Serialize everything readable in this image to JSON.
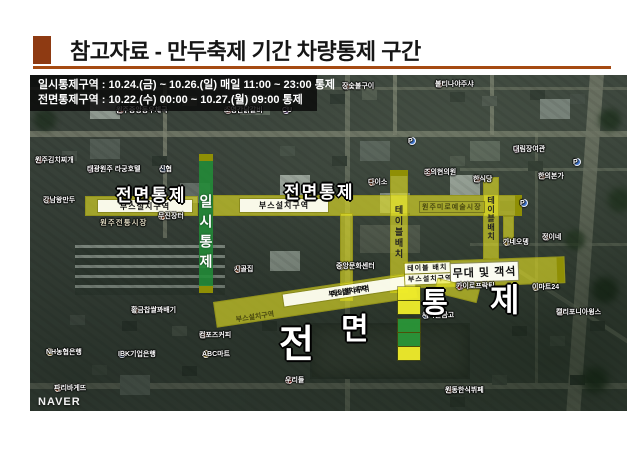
{
  "slide": {
    "title": "참고자료 - 만두축제 기간 차량통제 구간"
  },
  "info_box": {
    "line1": "일시통제구역 : 10.24.(금) ~ 10.26.(일) 매일 11:00 ~ 23:00 통제",
    "line2": "전면통제구역 : 10.22.(수) 00:00 ~ 10.27.(월) 09:00 통제"
  },
  "map": {
    "attribution": "NAVER",
    "labels": {
      "full_control_left": "전면통제",
      "full_control_mid": "전면통제",
      "temp_control": "일시통제",
      "big_letters": [
        "전",
        "면",
        "통",
        "제"
      ],
      "market": "원주미로예술시장"
    },
    "strips": {
      "booth_left": "부스설치구역",
      "booth_mid": "부스설치구역",
      "table_vertical": "테이블배치",
      "table_vertical2": "테이블배치",
      "table_bottom": "테이블 배치",
      "booth_bottom": "부스설치구역",
      "booth_bottom_small": "부스설치구역",
      "table_stage": "테이블 배치",
      "booth_stage": "부스설치구역",
      "stage": "무대 및 객석"
    },
    "permits": [
      {
        "text": "택배",
        "kind": "yellow"
      },
      {
        "text": "지점",
        "kind": "yellow"
      },
      {
        "text": "조업",
        "kind": "green"
      },
      {
        "text": "차량",
        "kind": "green"
      },
      {
        "text": "허용",
        "kind": "yellow"
      }
    ],
    "pois": [
      {
        "text": "장숯불구이",
        "x": 312,
        "y": 11,
        "dot": "#e8814d"
      },
      {
        "text": "불티나야주샤",
        "x": 405,
        "y": 9,
        "dot": "#e8814d"
      },
      {
        "text": "원주중앙동우체국",
        "x": 86,
        "y": 35,
        "dot": "#d9453a"
      },
      {
        "text": "소영간닭갈비",
        "x": 194,
        "y": 35,
        "dot": "#d9453a"
      },
      {
        "text": "CU",
        "x": 252,
        "y": 35,
        "dot": "#8b5fb8"
      },
      {
        "text": "원주김치찌개",
        "x": 5,
        "y": 85,
        "dot": "#d9453a"
      },
      {
        "text": "태광원주 라궁호텔",
        "x": 57,
        "y": 94,
        "dot": "#e084c0"
      },
      {
        "text": "신협",
        "x": 129,
        "y": 94,
        "dot": "#4a7fd4"
      },
      {
        "text": "강남왕만두",
        "x": 13,
        "y": 125,
        "dot": "#e8814d"
      },
      {
        "text": "무진장터",
        "x": 128,
        "y": 141,
        "dot": "#e8814d"
      },
      {
        "text": "원주전통시장",
        "x": 70,
        "y": 147,
        "dot": ""
      },
      {
        "text": "다이소",
        "x": 338,
        "y": 107,
        "dot": "#e8814d"
      },
      {
        "text": "조의현의원",
        "x": 394,
        "y": 97,
        "dot": "#d9453a"
      },
      {
        "text": "한식당",
        "x": 443,
        "y": 104,
        "dot": "#e8814d"
      },
      {
        "text": "대림장여관",
        "x": 483,
        "y": 74,
        "dot": "#e084c0"
      },
      {
        "text": "한의본가",
        "x": 508,
        "y": 101,
        "dot": "#e8814d"
      },
      {
        "text": "정이네",
        "x": 512,
        "y": 162,
        "dot": "#e8814d"
      },
      {
        "text": "시골집",
        "x": 204,
        "y": 194,
        "dot": "#e8814d"
      },
      {
        "text": "중앙문화센터",
        "x": 306,
        "y": 191,
        "dot": "#e3b93c"
      },
      {
        "text": "가네오뎅",
        "x": 473,
        "y": 167,
        "dot": "#e3b93c"
      },
      {
        "text": "이마트24",
        "x": 502,
        "y": 212,
        "dot": "#e3b93c"
      },
      {
        "text": "캘리포니아윙스",
        "x": 526,
        "y": 237,
        "dot": "#e8814d"
      },
      {
        "text": "새마을금고",
        "x": 392,
        "y": 240,
        "dot": "#4a7fd4"
      },
      {
        "text": "컴포즈커피",
        "x": 169,
        "y": 260,
        "dot": "#e8814d"
      },
      {
        "text": "ABC마트",
        "x": 172,
        "y": 279,
        "dot": "#e3b93c"
      },
      {
        "text": "NH농협은행",
        "x": 16,
        "y": 277,
        "dot": "#f0c030"
      },
      {
        "text": "IBK기업은행",
        "x": 88,
        "y": 279,
        "dot": "#4a7fd4"
      },
      {
        "text": "황금찹쌀꽈배기",
        "x": 101,
        "y": 235,
        "dot": "#e8814d"
      },
      {
        "text": "파리바게뜨",
        "x": 24,
        "y": 313,
        "dot": "#e8814d"
      },
      {
        "text": "우리들",
        "x": 255,
        "y": 305,
        "dot": "#d9453a"
      },
      {
        "text": "원동한식뷔페",
        "x": 415,
        "y": 315,
        "dot": "#e8814d"
      },
      {
        "text": "카이로프락틱",
        "x": 426,
        "y": 211,
        "dot": "#d9453a"
      },
      {
        "text": "P",
        "x": 378,
        "y": 66,
        "dot": "#3f74cc"
      },
      {
        "text": "P",
        "x": 490,
        "y": 128,
        "dot": "#3f74cc"
      },
      {
        "text": "P",
        "x": 543,
        "y": 87,
        "dot": "#3f74cc"
      }
    ]
  }
}
